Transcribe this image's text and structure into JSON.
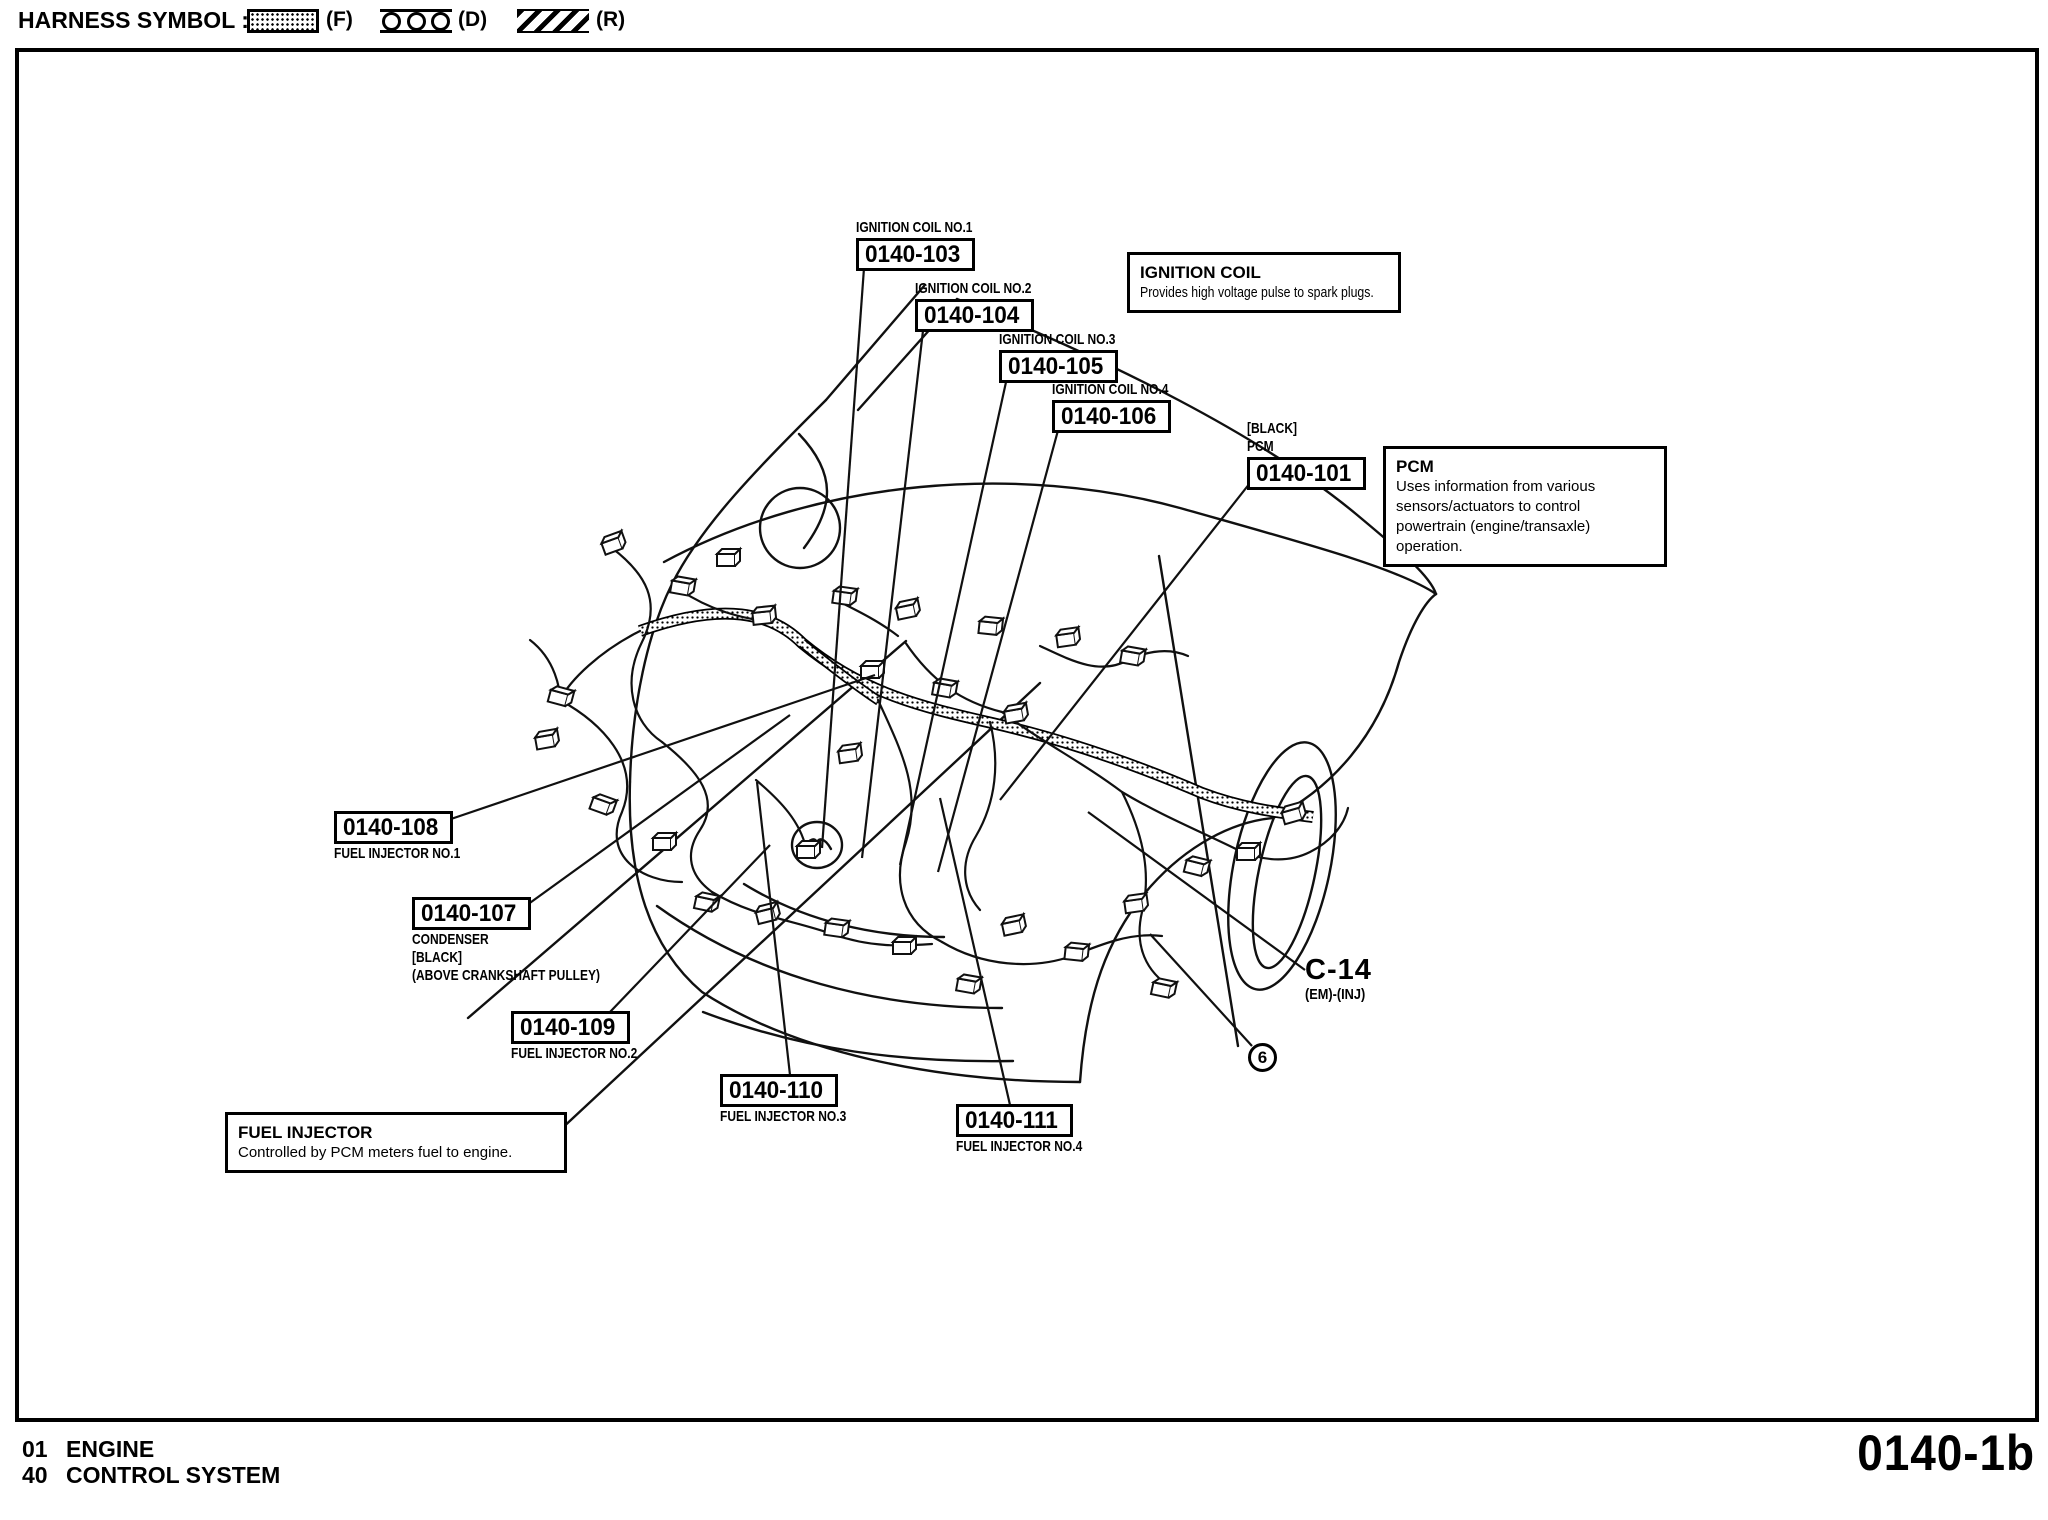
{
  "legend": {
    "label": "HARNESS SYMBOL :",
    "f_code": "(F)",
    "d_code": "(D)",
    "r_code": "(R)"
  },
  "callouts": {
    "c103": {
      "caption": "IGNITION COIL NO.1",
      "number": "0140-103"
    },
    "c104": {
      "caption": "IGNITION COIL NO.2",
      "number": "0140-104"
    },
    "c105": {
      "caption": "IGNITION COIL NO.3",
      "number": "0140-105"
    },
    "c106": {
      "caption": "IGNITION COIL NO.4",
      "number": "0140-106"
    },
    "c101": {
      "caption1": "[BLACK]",
      "caption2": "PCM",
      "number": "0140-101"
    },
    "c108": {
      "number": "0140-108",
      "caption": "FUEL INJECTOR NO.1"
    },
    "c107": {
      "number": "0140-107",
      "caption1": "CONDENSER",
      "caption2": "[BLACK]",
      "caption3": "(ABOVE CRANKSHAFT PULLEY)"
    },
    "c109": {
      "number": "0140-109",
      "caption": "FUEL INJECTOR NO.2"
    },
    "c110": {
      "number": "0140-110",
      "caption": "FUEL INJECTOR NO.3"
    },
    "c111": {
      "number": "0140-111",
      "caption": "FUEL INJECTOR NO.4"
    }
  },
  "info_boxes": {
    "ignition_coil": {
      "title": "IGNITION COIL",
      "body": "Provides high voltage pulse to spark plugs."
    },
    "pcm": {
      "title": "PCM",
      "body": "Uses information from various sensors/actuators to control powertrain (engine/transaxle) operation."
    },
    "fuel_injector": {
      "title": "FUEL INJECTOR",
      "body": "Controlled by PCM meters fuel to engine."
    }
  },
  "connector_ref": {
    "code": "C-14",
    "detail": "(EM)-(INJ)"
  },
  "harness_point": {
    "number": "6"
  },
  "footer": {
    "section1_num": "01",
    "section1_name": "ENGINE",
    "section2_num": "40",
    "section2_name": "CONTROL SYSTEM",
    "page_code": "0140-1b"
  },
  "colors": {
    "ink": "#000000",
    "paper": "#ffffff"
  }
}
